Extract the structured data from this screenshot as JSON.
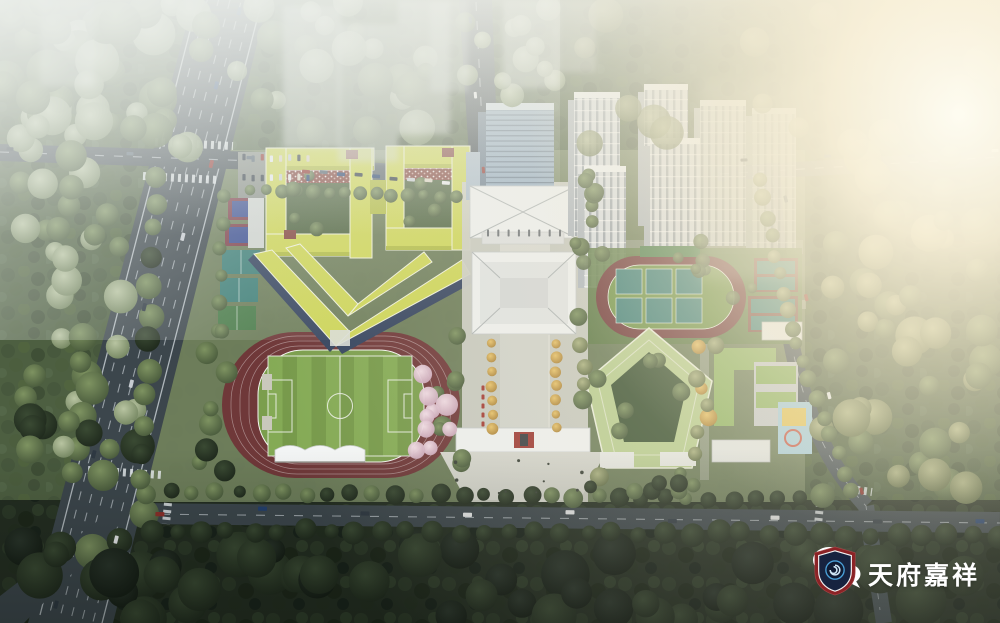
{
  "canvas": {
    "width": 1000,
    "height": 623,
    "subject": "aerial architectural rendering of a school campus master plan at dusk"
  },
  "watermark": {
    "brand": "天府嘉祥",
    "icons": [
      "wechat-icon",
      "shield-logo"
    ],
    "text_color": "#ffffff"
  },
  "palette": {
    "road": "#3c464c",
    "road_edge": "#59646b",
    "roof_yellow": "#ccd456",
    "roof_yellow_dark": "#b1bb45",
    "brick_red": "#81443d",
    "solar_blue": "#35445f",
    "track_maroon": "#6f3839",
    "infield_green": "#7b9e4d",
    "pitch_green": "#76994a",
    "pitch_stripe": "#84aa55",
    "court_teal": "#3f7f78",
    "blossom_pink": "#dfc3cf",
    "plaza": "#cbccc4",
    "white_roof": "#eceeed",
    "glass_blue": "#92aabf",
    "tower_body": "#d7dce0",
    "roof_green": "#b8cc90",
    "annex_green": "#8fb363",
    "gingko_yellow": "#d9a94f",
    "watermark_white": "#ffffff",
    "shield_red": "#8c2326",
    "shield_navy": "#17233f",
    "swirl_blue": "#4aa0d8",
    "mist_white": "#eef1ec",
    "sun_glare": "#fbf3dd"
  }
}
